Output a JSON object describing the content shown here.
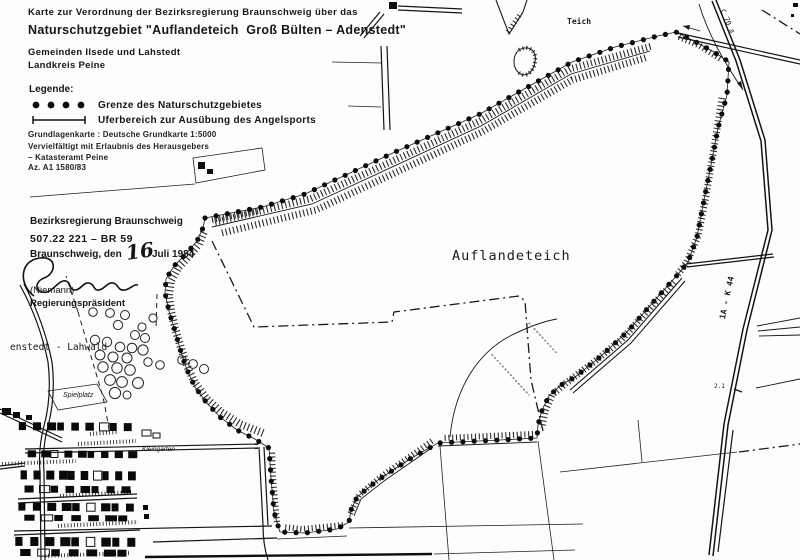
{
  "header": {
    "line1": "Karte zur Verordnung der Bezirksregierung Braunschweig über das",
    "line2": "Naturschutzgebiet \"Auflandeteich  Groß Bülten – Adenstedt\"",
    "line3": "Gemeinden Ilsede und Lahstedt",
    "line4": "Landkreis Peine"
  },
  "legend": {
    "title": "Legende:",
    "items": [
      {
        "symbol": "boundary-dots",
        "label": "Grenze des Naturschutzgebietes"
      },
      {
        "symbol": "bank-bracket",
        "label": "Uferbereich zur Ausübung des Angelsports"
      }
    ]
  },
  "source_note": {
    "line1": "Grundlagenkarte : Deutsche Grundkarte 1:5000",
    "line2": "Vervielfältigt mit Erlaubnis des Herausgebers",
    "line3": "– Katasteramt Peine",
    "line4": "Az. A1 1580/83"
  },
  "authority": {
    "name": "Bezirksregierung Braunschweig",
    "file_ref": "507.22 221 – BR 59",
    "place_date_prefix": "Braunschweig, den",
    "date_handwritten": "16",
    "date_suffix": "Juli 1984",
    "signer": "(Niemann)",
    "signer_title": "Regierungspräsident"
  },
  "map_labels": {
    "pond_main": "Auflandeteich",
    "pond_small": "Teich",
    "village": "enstedt - Lahwald",
    "playground": "Spielplatz",
    "allotments": "Kleingarten",
    "road_k44": "1A - K 44",
    "road_c70": "C 70 a",
    "elevation": "2.1"
  },
  "colors": {
    "ink": "#141414",
    "paper": "#fdfdfb"
  }
}
